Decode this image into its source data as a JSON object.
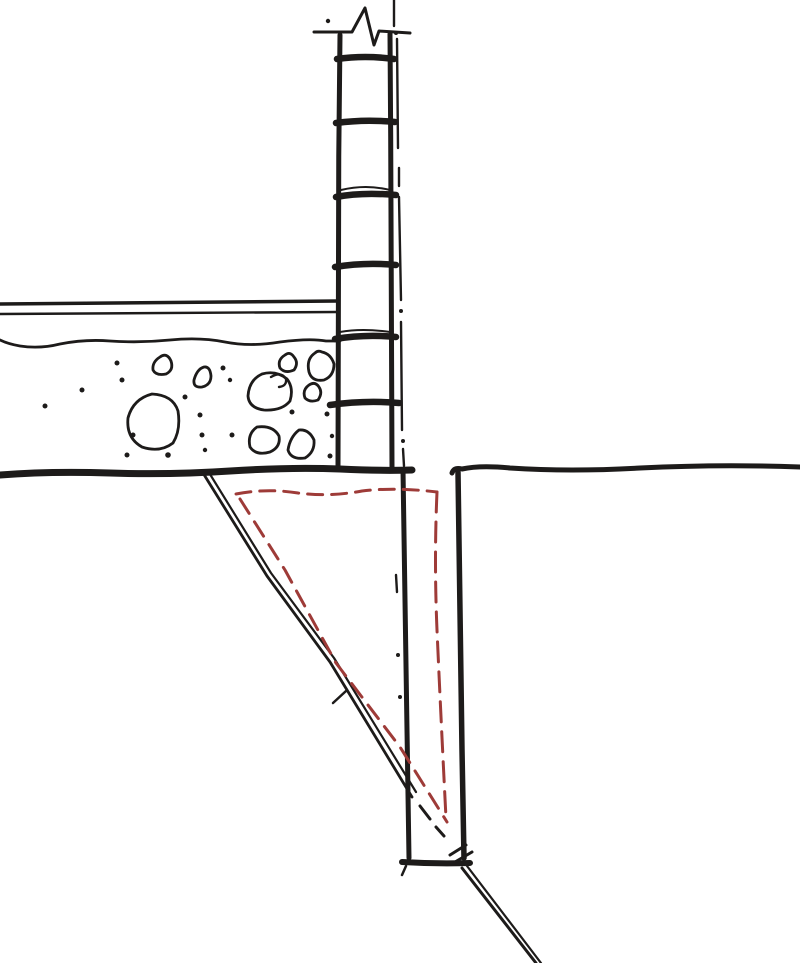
{
  "canvas": {
    "width": 800,
    "height": 963,
    "background": "#ffffff"
  },
  "colors": {
    "ink": "#1d1b1a",
    "red": "#9e3b38"
  },
  "drawing": {
    "description_name": "foundation-wall-section-sketch",
    "shapes": [
      {
        "name": "break-line",
        "type": "path",
        "d": "M314,32 L352,32 L365,8 L374,45 L379,31 L410,33",
        "stroke": "ink",
        "w": 3
      },
      {
        "name": "break-line-dot",
        "type": "circle",
        "cx": 328,
        "cy": 21,
        "r": 2.2,
        "fill": "ink"
      },
      {
        "name": "centerline-segment",
        "type": "path",
        "d": "M394,0 L394,26",
        "stroke": "ink",
        "w": 2.4
      },
      {
        "name": "centerline-dot",
        "type": "circle",
        "cx": 396,
        "cy": 33,
        "r": 2,
        "fill": "ink"
      },
      {
        "name": "centerline-segment",
        "type": "path",
        "d": "M397,39 L398,148",
        "stroke": "ink",
        "w": 2.4
      },
      {
        "name": "centerline-segment",
        "type": "path",
        "d": "M399,168 L399,186",
        "stroke": "ink",
        "w": 2.4
      },
      {
        "name": "centerline-segment",
        "type": "path",
        "d": "M399,197 L401,300",
        "stroke": "ink",
        "w": 2.4
      },
      {
        "name": "centerline-dot",
        "type": "circle",
        "cx": 401,
        "cy": 311,
        "r": 2,
        "fill": "ink"
      },
      {
        "name": "centerline-segment",
        "type": "path",
        "d": "M401,322 L402,430",
        "stroke": "ink",
        "w": 2.4
      },
      {
        "name": "centerline-dot",
        "type": "circle",
        "cx": 403,
        "cy": 441,
        "r": 2,
        "fill": "ink"
      },
      {
        "name": "centerline-segment",
        "type": "path",
        "d": "M403,449 L404,466",
        "stroke": "ink",
        "w": 2.4
      },
      {
        "name": "centerline-segment",
        "type": "path",
        "d": "M396,575 L397,592",
        "stroke": "ink",
        "w": 2.4
      },
      {
        "name": "centerline-dot",
        "type": "circle",
        "cx": 398,
        "cy": 655,
        "r": 2,
        "fill": "ink"
      },
      {
        "name": "centerline-dot",
        "type": "circle",
        "cx": 400,
        "cy": 697,
        "r": 2,
        "fill": "ink"
      },
      {
        "name": "masonry-wall-left-edge",
        "type": "path",
        "d": "M340,35 C338,180 338,330 338,467",
        "stroke": "ink",
        "w": 5
      },
      {
        "name": "masonry-wall-right-edge",
        "type": "path",
        "d": "M390,34 C391,180 392,330 392,467",
        "stroke": "ink",
        "w": 5
      },
      {
        "name": "masonry-course-line",
        "type": "path",
        "d": "M337,59 Q365,55 394,59",
        "stroke": "ink",
        "w": 6.5
      },
      {
        "name": "masonry-course-line",
        "type": "path",
        "d": "M336,123 Q365,119 395,122",
        "stroke": "ink",
        "w": 6.5
      },
      {
        "name": "masonry-course-echo",
        "type": "path",
        "d": "M341,190 Q366,184 390,190",
        "stroke": "ink",
        "w": 2
      },
      {
        "name": "masonry-course-line",
        "type": "path",
        "d": "M336,197 Q362,192 396,195",
        "stroke": "ink",
        "w": 6.5
      },
      {
        "name": "masonry-course-line",
        "type": "path",
        "d": "M335,267 Q365,262 396,265",
        "stroke": "ink",
        "w": 6.5
      },
      {
        "name": "masonry-course-echo",
        "type": "path",
        "d": "M340,332 Q362,328 390,332",
        "stroke": "ink",
        "w": 2
      },
      {
        "name": "masonry-course-line",
        "type": "path",
        "d": "M335,339 Q365,334 396,337",
        "stroke": "ink",
        "w": 6.5
      },
      {
        "name": "masonry-course-line",
        "type": "path",
        "d": "M330,405 Q365,400 399,403",
        "stroke": "ink",
        "w": 6.5
      },
      {
        "name": "slab-top-line",
        "type": "path",
        "d": "M0,304 L338,301",
        "stroke": "ink",
        "w": 3.5
      },
      {
        "name": "slab-top-line-2",
        "type": "path",
        "d": "M0,314 L337,312",
        "stroke": "ink",
        "w": 2.4
      },
      {
        "name": "gravel-top-wavy-line",
        "type": "path",
        "d": "M0,340 Q8,344 20,346 Q40,349 60,344 Q85,339 110,341 Q140,343 170,340 Q200,337 225,342 Q250,347 280,342 Q310,338 326,341 L340,341",
        "stroke": "ink",
        "w": 2.8
      },
      {
        "name": "aggregate-stone",
        "type": "path",
        "d": "M160,357 Q152,362 153,370 Q156,376 166,374 Q174,370 171,361 Q167,352 160,357 Z",
        "stroke": "ink",
        "w": 2.8
      },
      {
        "name": "aggregate-stone",
        "type": "path",
        "d": "M204,367 Q197,369 194,380 Q193,388 202,387 Q211,385 211,376 Q210,366 204,367 Z",
        "stroke": "ink",
        "w": 2.8
      },
      {
        "name": "aggregate-stone",
        "type": "path",
        "d": "M152,394 Q133,399 128,418 Q126,438 142,447 Q160,453 173,443 Q181,430 178,411 Q173,395 152,394 Z",
        "stroke": "ink",
        "w": 2.8
      },
      {
        "name": "aggregate-stone",
        "type": "path",
        "d": "M262,374 Q249,380 248,396 Q249,408 264,410 Q282,411 290,401 Q294,388 287,379 Q276,370 262,374 Z",
        "stroke": "ink",
        "w": 2.8
      },
      {
        "name": "aggregate-stone-curl",
        "type": "path",
        "d": "M271,377 Q281,371 286,379 Q287,386 279,387",
        "stroke": "ink",
        "w": 2.4
      },
      {
        "name": "aggregate-stone",
        "type": "path",
        "d": "M285,355 Q277,360 280,368 Q285,374 294,370 Q299,363 294,357 Q290,351 285,355 Z",
        "stroke": "ink",
        "w": 2.8
      },
      {
        "name": "aggregate-stone",
        "type": "path",
        "d": "M315,353 Q306,359 309,372 Q312,382 324,380 Q334,376 334,364 Q331,354 322,352 Q318,350 315,353 Z",
        "stroke": "ink",
        "w": 2.8
      },
      {
        "name": "aggregate-stone",
        "type": "path",
        "d": "M309,385 Q302,390 305,398 Q310,403 318,400 Q323,393 319,387 Q315,381 309,385 Z",
        "stroke": "ink",
        "w": 2.8
      },
      {
        "name": "aggregate-stone",
        "type": "path",
        "d": "M257,427 Q247,434 250,447 Q256,456 270,452 Q281,447 279,436 Q273,425 257,427 Z",
        "stroke": "ink",
        "w": 2.8
      },
      {
        "name": "aggregate-stone",
        "type": "path",
        "d": "M299,430 Q290,437 288,450 Q291,460 305,458 Q315,452 314,440 Q309,429 299,430 Z",
        "stroke": "ink",
        "w": 2.8
      },
      {
        "name": "aggregate-dot",
        "type": "circle",
        "cx": 117,
        "cy": 363,
        "r": 2.5,
        "fill": "ink"
      },
      {
        "name": "aggregate-dot",
        "type": "circle",
        "cx": 122,
        "cy": 380,
        "r": 2.5,
        "fill": "ink"
      },
      {
        "name": "aggregate-dot",
        "type": "circle",
        "cx": 82,
        "cy": 390,
        "r": 2.5,
        "fill": "ink"
      },
      {
        "name": "aggregate-dot",
        "type": "circle",
        "cx": 45,
        "cy": 406,
        "r": 2.5,
        "fill": "ink"
      },
      {
        "name": "aggregate-dot",
        "type": "circle",
        "cx": 185,
        "cy": 397,
        "r": 2.5,
        "fill": "ink"
      },
      {
        "name": "aggregate-dot",
        "type": "circle",
        "cx": 223,
        "cy": 368,
        "r": 2.5,
        "fill": "ink"
      },
      {
        "name": "aggregate-dot",
        "type": "circle",
        "cx": 230,
        "cy": 380,
        "r": 2.2,
        "fill": "ink"
      },
      {
        "name": "aggregate-dot",
        "type": "circle",
        "cx": 200,
        "cy": 415,
        "r": 2.5,
        "fill": "ink"
      },
      {
        "name": "aggregate-dot",
        "type": "circle",
        "cx": 202,
        "cy": 435,
        "r": 2.5,
        "fill": "ink"
      },
      {
        "name": "aggregate-dot",
        "type": "circle",
        "cx": 133,
        "cy": 435,
        "r": 2.5,
        "fill": "ink"
      },
      {
        "name": "aggregate-dot",
        "type": "circle",
        "cx": 127,
        "cy": 455,
        "r": 2.5,
        "fill": "ink"
      },
      {
        "name": "aggregate-dot",
        "type": "circle",
        "cx": 168,
        "cy": 455,
        "r": 2.8,
        "fill": "ink"
      },
      {
        "name": "aggregate-dot",
        "type": "circle",
        "cx": 205,
        "cy": 450,
        "r": 2.2,
        "fill": "ink"
      },
      {
        "name": "aggregate-dot",
        "type": "circle",
        "cx": 232,
        "cy": 435,
        "r": 2.5,
        "fill": "ink"
      },
      {
        "name": "aggregate-dot",
        "type": "circle",
        "cx": 292,
        "cy": 412,
        "r": 2.5,
        "fill": "ink"
      },
      {
        "name": "aggregate-dot",
        "type": "circle",
        "cx": 327,
        "cy": 414,
        "r": 2.5,
        "fill": "ink"
      },
      {
        "name": "aggregate-dot",
        "type": "circle",
        "cx": 332,
        "cy": 436,
        "r": 2.2,
        "fill": "ink"
      },
      {
        "name": "aggregate-dot",
        "type": "circle",
        "cx": 330,
        "cy": 456,
        "r": 2.5,
        "fill": "ink"
      },
      {
        "name": "grade-line-left",
        "type": "path",
        "d": "M0,475 Q50,471 110,473 Q170,475 230,471 Q290,467 340,469 Q380,471 412,470",
        "stroke": "ink",
        "w": 7
      },
      {
        "name": "grade-line-right",
        "type": "path",
        "d": "M452,473 Q454,467 462,469 Q480,465 510,468 Q570,472 640,468 Q720,464 800,467",
        "stroke": "ink",
        "w": 5
      },
      {
        "name": "foundation-wall-left-edge",
        "type": "path",
        "d": "M403,470 Q405,610 407,730 L409,858",
        "stroke": "ink",
        "w": 5
      },
      {
        "name": "foundation-wall-right-edge",
        "type": "path",
        "d": "M458,472 Q460,620 462,750 L464,858",
        "stroke": "ink",
        "w": 5.5
      },
      {
        "name": "footing-bottom-line",
        "type": "path",
        "d": "M402,862 Q435,864 470,863",
        "stroke": "ink",
        "w": 6
      },
      {
        "name": "footing-left-tick",
        "type": "path",
        "d": "M406,866 L402,875",
        "stroke": "ink",
        "w": 2.5
      },
      {
        "name": "footing-corner-tick",
        "type": "path",
        "d": "M450,855 L466,845",
        "stroke": "ink",
        "w": 3
      },
      {
        "name": "footing-corner-tick",
        "type": "path",
        "d": "M455,862 L472,852",
        "stroke": "ink",
        "w": 3
      },
      {
        "name": "excavation-slope-line-outer",
        "type": "path",
        "d": "M203,473 L267,576 L330,662 L412,797",
        "stroke": "ink",
        "w": 2.8
      },
      {
        "name": "excavation-slope-line-inner",
        "type": "path",
        "d": "M208,471 L271,573 L334,658 L416,792",
        "stroke": "ink",
        "w": 2.2
      },
      {
        "name": "excavation-slope-tick",
        "type": "path",
        "d": "M333,703 L346,691",
        "stroke": "ink",
        "w": 2.5
      },
      {
        "name": "excavation-slope-dash",
        "type": "path",
        "d": "M420,806 L430,819",
        "stroke": "ink",
        "w": 3
      },
      {
        "name": "excavation-slope-dash",
        "type": "path",
        "d": "M436,827 L444,836",
        "stroke": "ink",
        "w": 3
      },
      {
        "name": "lower-slope-line-outer",
        "type": "path",
        "d": "M462,868 L536,963",
        "stroke": "ink",
        "w": 3
      },
      {
        "name": "lower-slope-line-inner",
        "type": "path",
        "d": "M467,866 L541,963",
        "stroke": "ink",
        "w": 2.2
      },
      {
        "name": "red-excavation-outline-top",
        "type": "path",
        "d": "M236,494 Q266,488 298,493 Q330,497 362,491 Q395,487 437,492",
        "stroke": "red",
        "w": 3,
        "dash": "15 9"
      },
      {
        "name": "red-excavation-outline-right",
        "type": "path",
        "d": "M437,492 Q434,560 437,630 Q441,720 446,818",
        "stroke": "red",
        "w": 3,
        "dash": "20 10"
      },
      {
        "name": "red-excavation-outline-hypotenuse",
        "type": "path",
        "d": "M240,499 L285,570 L336,663 L400,747 L447,822",
        "stroke": "red",
        "w": 3,
        "dash": "17 10"
      }
    ]
  }
}
